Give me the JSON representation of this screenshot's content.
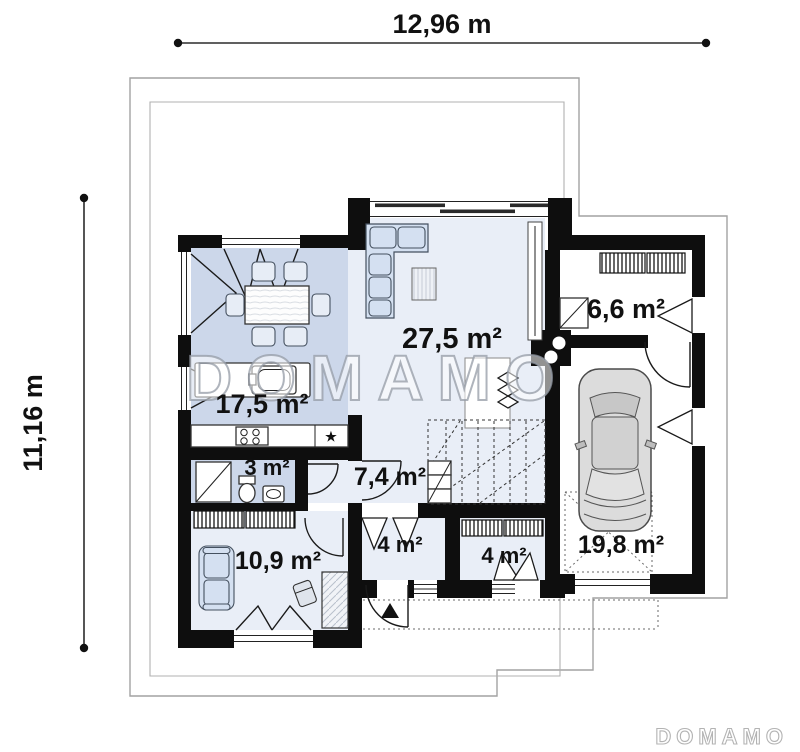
{
  "dimensions": {
    "width_label": "12,96 m",
    "height_label": "11,16 m"
  },
  "watermark": {
    "text": "DOMAMO"
  },
  "brand": {
    "logo_text": "DOMAMO"
  },
  "rooms": [
    {
      "id": "living-room",
      "area": "27,5 m²"
    },
    {
      "id": "kitchen-dining",
      "area": "17,5 m²"
    },
    {
      "id": "utility-room",
      "area": "6,6 m²"
    },
    {
      "id": "bathroom",
      "area": "3 m²"
    },
    {
      "id": "hall-stairs",
      "area": "7,4 m²"
    },
    {
      "id": "bedroom-office",
      "area": "10,9 m²"
    },
    {
      "id": "entry-hall",
      "area": "4 m²"
    },
    {
      "id": "wardrobe",
      "area": "4 m²"
    },
    {
      "id": "garage",
      "area": "19,8 m²"
    }
  ],
  "icons": {
    "cooker_star": "★"
  },
  "colors": {
    "wall": "#0e0e0e",
    "floor_blue": "#ccd7ea",
    "floor_light": "#e9eef7",
    "furniture_blue": "#d4e0f1",
    "roof_outline": "#a2a2a2"
  }
}
